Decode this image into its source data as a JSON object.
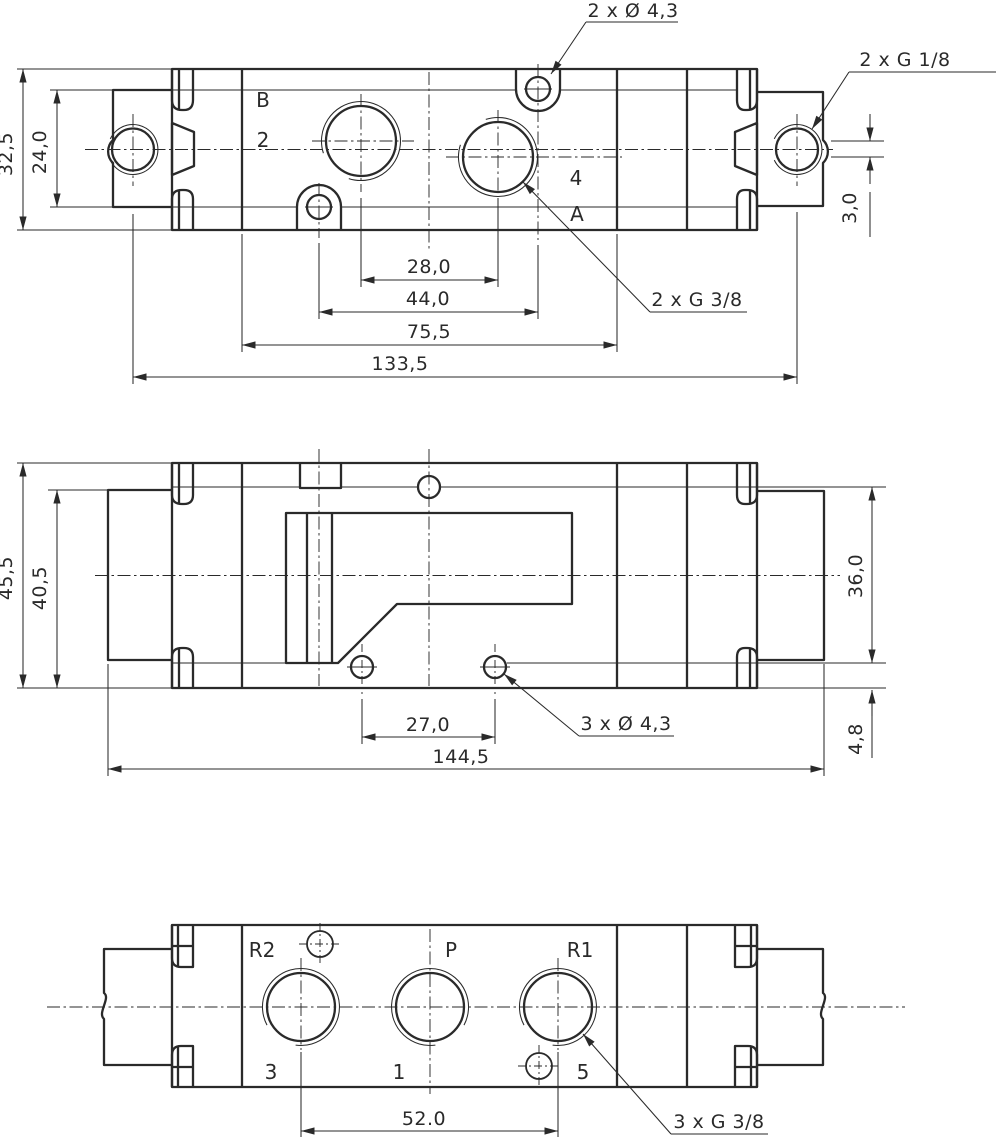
{
  "title": "Pneumatic valve body technical drawing",
  "colors": {
    "line": "#2a2a2a",
    "background": "#ffffff"
  },
  "views": {
    "top": {
      "port_labels": {
        "b": "B",
        "two": "2",
        "four": "4",
        "a": "A"
      },
      "dims": {
        "body_height": "32,5",
        "block_height": "24,0",
        "port_spacing": "28,0",
        "hole_spacing": "44,0",
        "face_width": "75,5",
        "overall_length": "133,5",
        "port_offset": "3,0"
      },
      "annotations": {
        "mount_holes": "2 x Ø 4,3",
        "pilot_ports": "2 x G 1/8",
        "work_ports": "2 x G 3/8"
      }
    },
    "side": {
      "dims": {
        "body_height": "45,5",
        "block_height": "40,5",
        "hole_spacing": "27,0",
        "overall_length": "144,5",
        "face_height": "36,0",
        "foot_height": "4,8"
      },
      "annotations": {
        "mount_holes": "3 x Ø 4,3"
      }
    },
    "bottom": {
      "port_labels": {
        "r2": "R2",
        "p": "P",
        "r1": "R1",
        "three": "3",
        "one": "1",
        "five": "5"
      },
      "dims": {
        "port_spacing": "52.0"
      },
      "annotations": {
        "work_ports": "3 x G 3/8"
      }
    }
  }
}
